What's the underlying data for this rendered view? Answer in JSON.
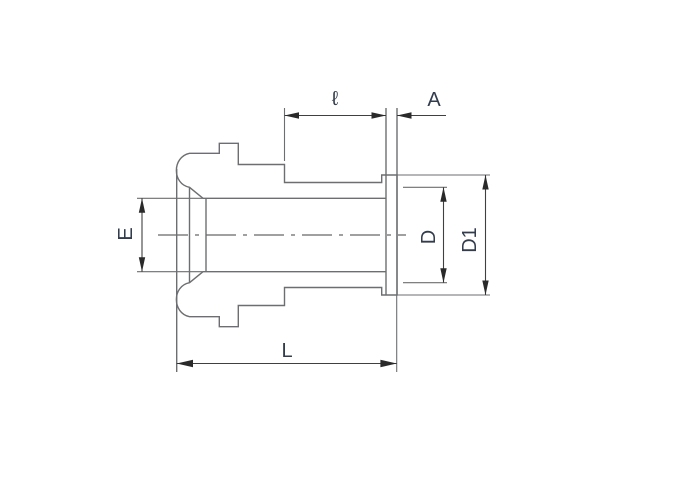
{
  "drawing": {
    "title": "tube fitting gland dimensional outline drawing",
    "type": "engineering-line-drawing"
  },
  "labels": {
    "l": "ℓ",
    "A": "A",
    "E": "E",
    "D": "D",
    "D1": "D1",
    "L": "L"
  },
  "dimensions": [
    {
      "label": "ℓ",
      "orientation": "horizontal",
      "measures": "thread / neck length ahead of flange"
    },
    {
      "label": "A",
      "orientation": "horizontal",
      "measures": "flange thickness"
    },
    {
      "label": "E",
      "orientation": "vertical",
      "measures": "tube outside diameter at left"
    },
    {
      "label": "D",
      "orientation": "vertical",
      "measures": "gland face diameter"
    },
    {
      "label": "D1",
      "orientation": "vertical",
      "measures": "flange outside diameter"
    },
    {
      "label": "L",
      "orientation": "horizontal",
      "measures": "overall body length"
    }
  ],
  "colors": {
    "background": "#ffffff",
    "body_line": "#6d6e71",
    "dimension_line": "#404041",
    "arrow": "#2a2a2a",
    "label_text": "#323c4c"
  }
}
